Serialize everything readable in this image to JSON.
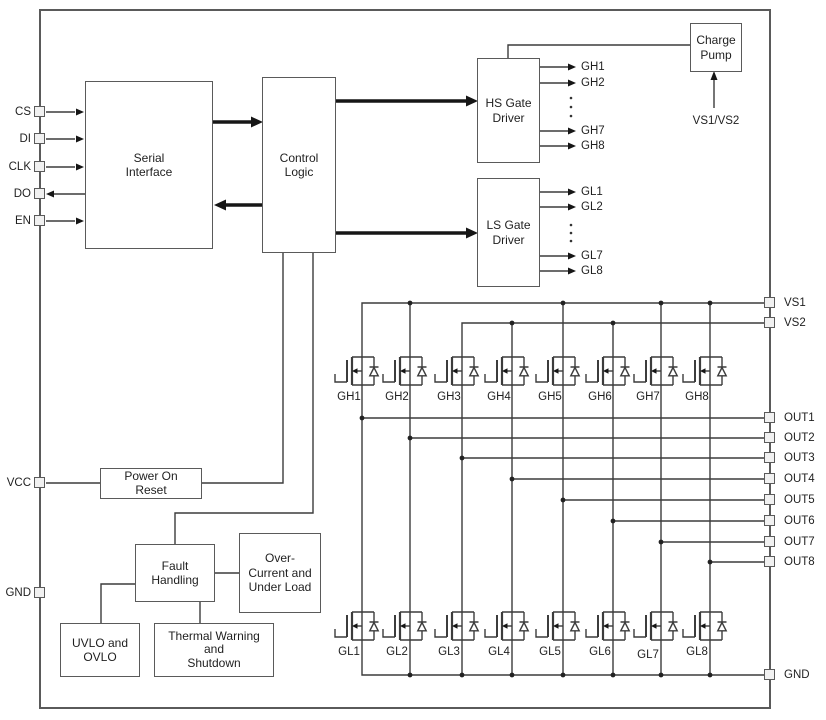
{
  "blocks": {
    "serial_interface": {
      "lines": [
        "Serial",
        "Interface"
      ]
    },
    "control_logic": {
      "lines": [
        "Control",
        "Logic"
      ]
    },
    "hs_gate_driver": {
      "lines": [
        "HS Gate",
        "Driver"
      ]
    },
    "ls_gate_driver": {
      "lines": [
        "LS Gate",
        "Driver"
      ]
    },
    "charge_pump": {
      "lines": [
        "Charge",
        "Pump"
      ]
    },
    "power_on_reset": {
      "lines": [
        "Power On",
        "Reset"
      ]
    },
    "fault_handling": {
      "lines": [
        "Fault",
        "Handling"
      ]
    },
    "over_current_under_load": {
      "lines": [
        "Over-",
        "Current and",
        "Under Load"
      ]
    },
    "uvlo_ovlo": {
      "lines": [
        "UVLO and",
        "OVLO"
      ]
    },
    "thermal_warning_shutdown": {
      "lines": [
        "Thermal Warning",
        "and",
        "Shutdown"
      ]
    }
  },
  "pins": {
    "left": [
      "CS",
      "DI",
      "CLK",
      "DO",
      "EN",
      "VCC",
      "GND"
    ],
    "right": [
      "VS1",
      "VS2",
      "OUT1",
      "OUT2",
      "OUT3",
      "OUT4",
      "OUT5",
      "OUT6",
      "OUT7",
      "OUT8",
      "GND"
    ]
  },
  "signals": {
    "hs_gate_outputs": [
      "GH1",
      "GH2",
      "GH7",
      "GH8"
    ],
    "ls_gate_outputs": [
      "GL1",
      "GL2",
      "GL7",
      "GL8"
    ],
    "charge_pump_supply": "VS1/VS2",
    "high_side_fets": [
      "GH1",
      "GH2",
      "GH3",
      "GH4",
      "GH5",
      "GH6",
      "GH7",
      "GH8"
    ],
    "low_side_fets": [
      "GL1",
      "GL2",
      "GL3",
      "GL4",
      "GL5",
      "GL6",
      "GL7",
      "GL8"
    ]
  },
  "colors": {
    "background": "#ffffff",
    "wire": "#3c3c3c",
    "block_border": "#5a5a5a",
    "text": "#1f1f1f",
    "arrow": "#161616",
    "pin_fill": "#f1f1f1"
  }
}
